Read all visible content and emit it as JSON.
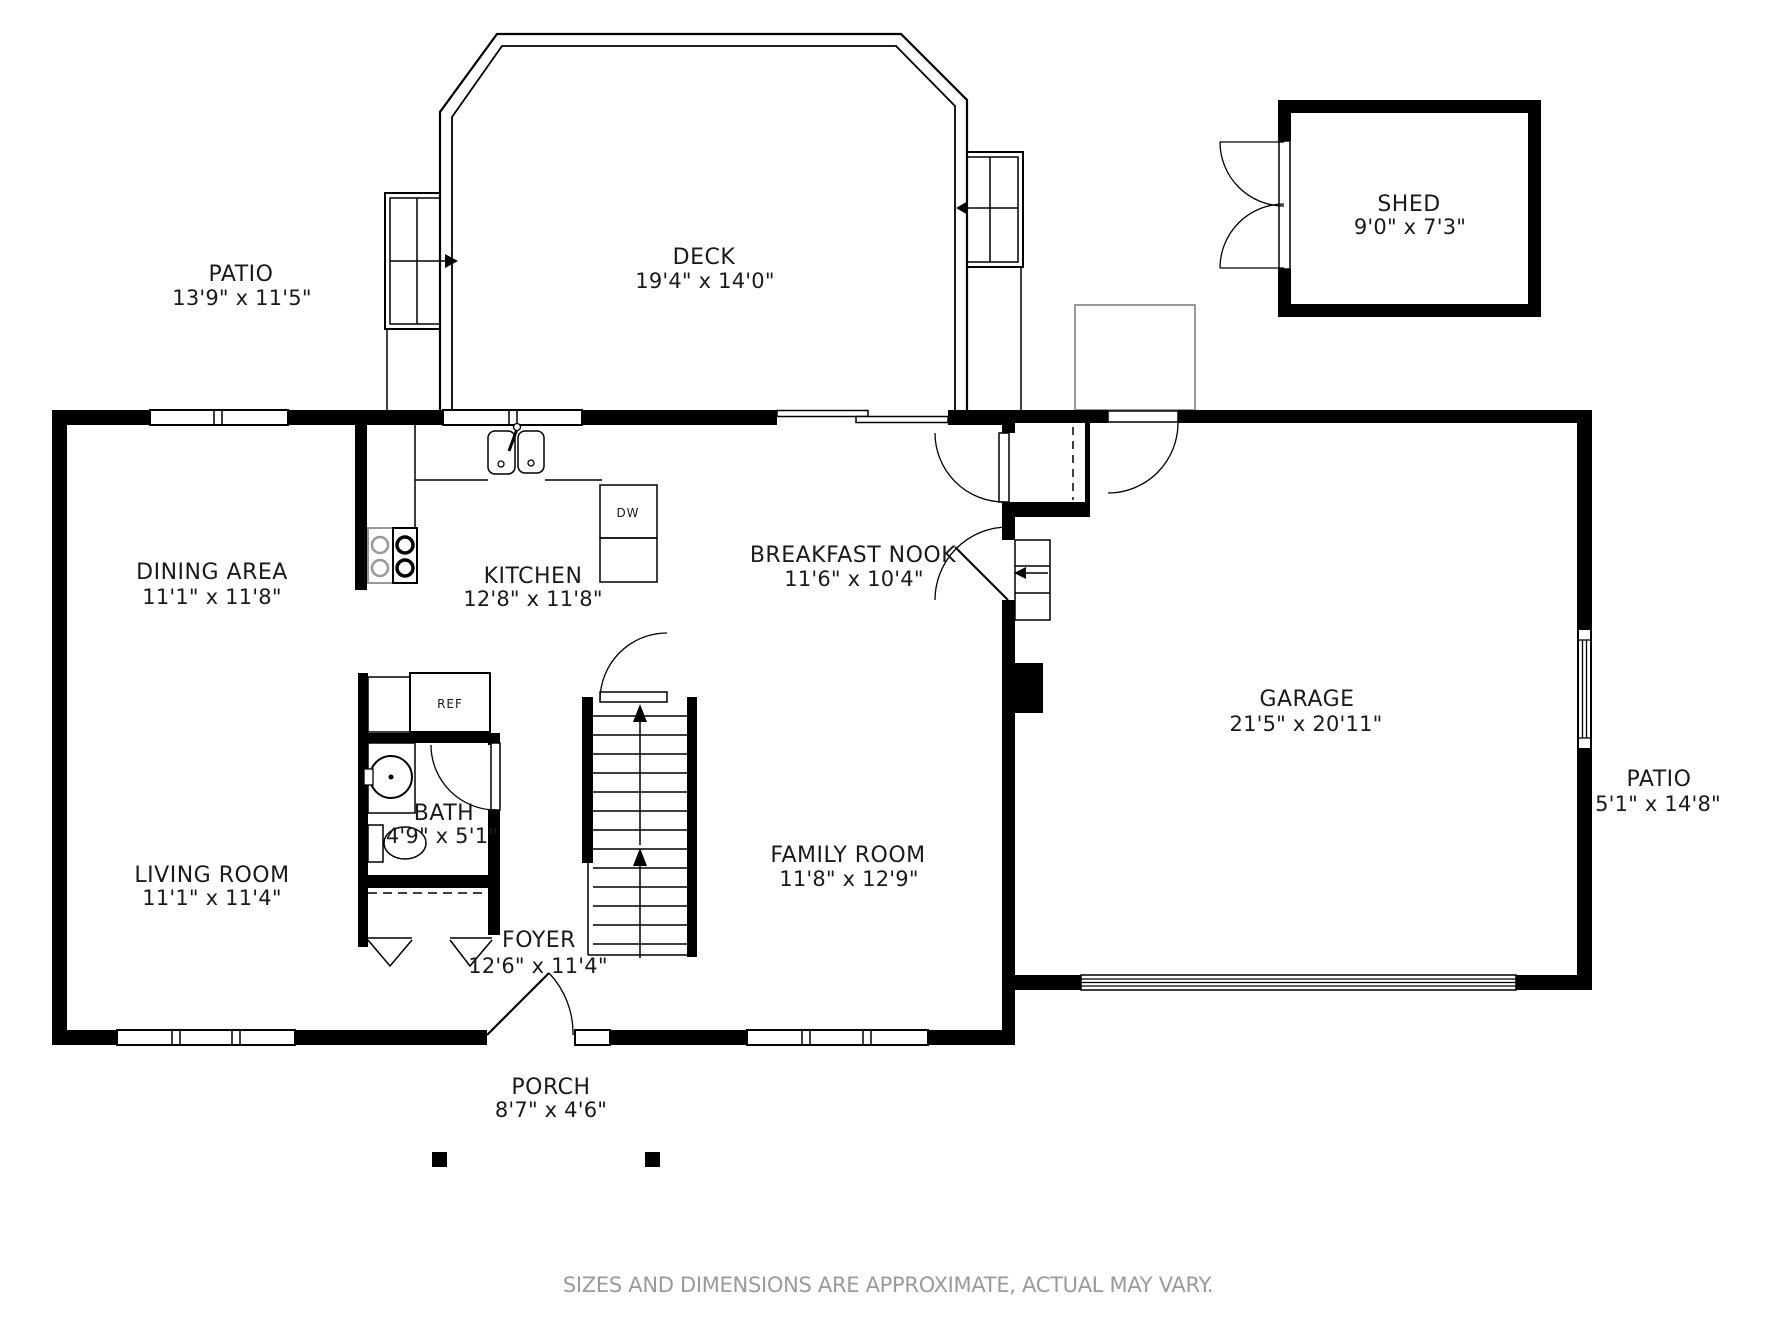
{
  "rooms": {
    "patio_top": {
      "name": "PATIO",
      "dims": "13'9\" x 11'5\""
    },
    "deck": {
      "name": "DECK",
      "dims": "19'4\" x 14'0\""
    },
    "shed": {
      "name": "SHED",
      "dims": "9'0\" x 7'3\""
    },
    "dining": {
      "name": "DINING AREA",
      "dims": "11'1\" x 11'8\""
    },
    "kitchen": {
      "name": "KITCHEN",
      "dims": "12'8\" x 11'8\""
    },
    "nook": {
      "name": "BREAKFAST NOOK",
      "dims": "11'6\" x 10'4\""
    },
    "garage": {
      "name": "GARAGE",
      "dims": "21'5\" x 20'11\""
    },
    "patio_right": {
      "name": "PATIO",
      "dims": "5'1\" x 14'8\""
    },
    "living": {
      "name": "LIVING ROOM",
      "dims": "11'1\" x 11'4\""
    },
    "bath": {
      "name": "BATH",
      "dims": "4'9\" x 5'1\""
    },
    "family": {
      "name": "FAMILY ROOM",
      "dims": "11'8\" x 12'9\""
    },
    "foyer": {
      "name": "FOYER",
      "dims": "12'6\" x 11'4\""
    },
    "porch": {
      "name": "PORCH",
      "dims": "8'7\" x 4'6\""
    }
  },
  "appliances": {
    "dishwasher": "DW",
    "refrigerator": "REF"
  },
  "footer": "SIZES AND DIMENSIONS ARE APPROXIMATE, ACTUAL MAY VARY.",
  "colors": {
    "wall": "#000000",
    "label": "#1a1a1a",
    "muted": "#9a9a9a",
    "outdoor_outline": "#999999"
  }
}
